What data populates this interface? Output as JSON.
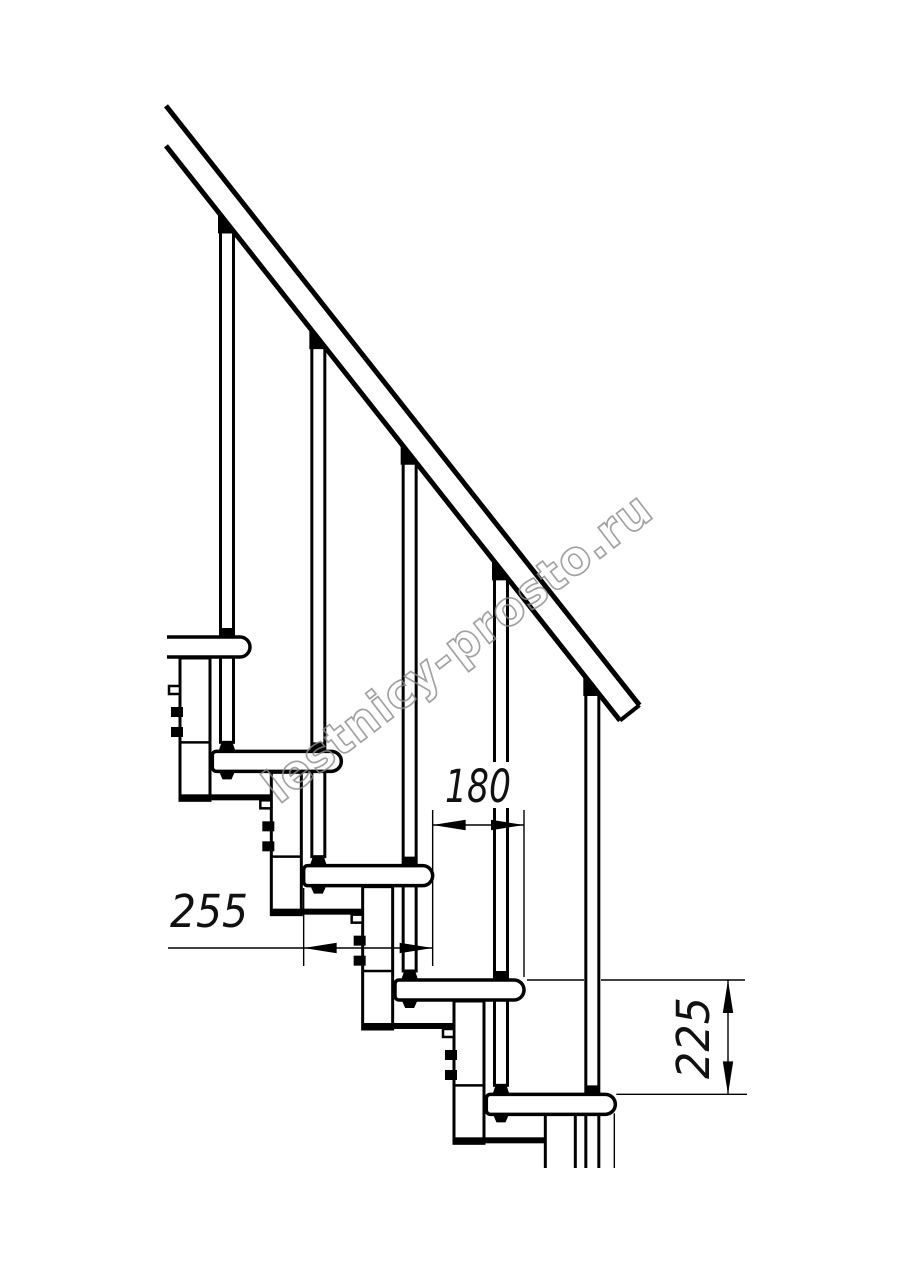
{
  "diagram": {
    "watermark": "lestnicy-prosto.ru",
    "dimensions": [
      {
        "label": "180",
        "orientation": "horizontal",
        "measures": "going between tread noses"
      },
      {
        "label": "255",
        "orientation": "horizontal",
        "measures": "tread depth"
      },
      {
        "label": "225",
        "orientation": "vertical",
        "measures": "step rise"
      }
    ],
    "colors": {
      "line": "#000000",
      "watermark": "#8a8a8a",
      "background": "#ffffff"
    },
    "steps_visible": 5
  }
}
